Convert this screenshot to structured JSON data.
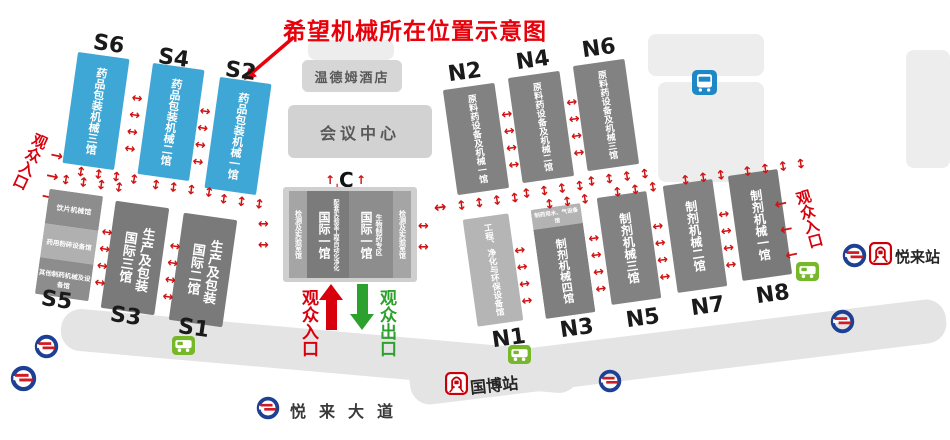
{
  "title": "希望机械所在位置示意图",
  "colors": {
    "highlight_hall_blue": "#3fa7d6",
    "hall_dark_gray": "#7f7f7f",
    "hall_light_gray": "#b5b5b5",
    "arrow_red": "#cf1212",
    "entrance_red": "#d9000d",
    "exit_green": "#2da12d",
    "title_red": "#e8000a",
    "metro_logo_blue": "#1d4094",
    "station_red": "#c8000a",
    "bus_green": "#76b82a",
    "bus_blue": "#1e88c7"
  },
  "icons": {
    "metro_logo": "chongqing-rail-transit-logo",
    "train_station": "rail-station-icon",
    "bus_stop": "bus-stop-icon"
  },
  "buildings": {
    "hotel": "温德姆酒店",
    "conference_center": "会议中心",
    "gate_c": "C"
  },
  "halls": {
    "s_top": [
      {
        "code": "S6",
        "name": "药品包装机械三馆"
      },
      {
        "code": "S4",
        "name": "药品包装机械二馆"
      },
      {
        "code": "S2",
        "name": "药品包装机械一馆"
      }
    ],
    "s5": {
      "code": "S5",
      "segments": [
        "饮片机械馆",
        "药用粉碎设备馆",
        "其他制药机械及设备馆"
      ]
    },
    "s_bottom": [
      {
        "code": "S3",
        "line1": "生产及包装",
        "line2": "国际三馆"
      },
      {
        "code": "S1",
        "line1": "生产及包装",
        "line2": "国际二馆"
      }
    ],
    "n_top": [
      {
        "code": "N2",
        "name": "原料药设备及机械一馆"
      },
      {
        "code": "N4",
        "name": "原料药设备及机械二馆"
      },
      {
        "code": "N6",
        "name": "原料药设备及机械三馆"
      }
    ],
    "n1": {
      "code": "N1",
      "name": "工程、净化与环保设备馆"
    },
    "n3": {
      "code": "N3",
      "header": "制药用水、气设备馆",
      "name": "制剂机械四馆"
    },
    "n_bottom": [
      {
        "code": "N5",
        "name": "制剂机械三馆"
      },
      {
        "code": "N7",
        "name": "制剂机械二馆"
      },
      {
        "code": "N8",
        "name": "制剂机械一馆"
      }
    ],
    "center": {
      "lab_left": "检测及实验室馆",
      "intl_left": "国际一馆",
      "intl_left_sub": "配套实验室工程自动化净化",
      "intl_right": "国际一馆",
      "intl_right_sub": "生物制药专区",
      "lab_right": "检测及实验室馆"
    }
  },
  "entrances": {
    "left": "观众入口",
    "right": "观众入口",
    "center_in": "观众入口",
    "center_out": "观众出口"
  },
  "stations": {
    "guobo": "国博站",
    "yuelai": "悦来站",
    "avenue": "悦来大道"
  }
}
